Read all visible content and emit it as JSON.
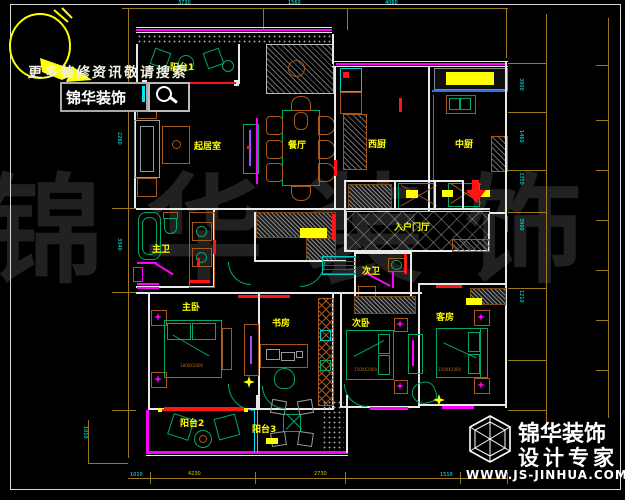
{
  "branding_top": {
    "slogan": "更多装修资讯敬请搜索",
    "brand": "锦华装饰"
  },
  "branding_bottom": {
    "brand": "锦华装饰",
    "tagline": "设计专家",
    "website": "WWW.JS-JINHUA.COM"
  },
  "watermark": {
    "text": "锦华装饰"
  },
  "rooms": [
    {
      "id": "balcony-1",
      "label": "阳台1"
    },
    {
      "id": "living-room",
      "label": "起居室"
    },
    {
      "id": "dining-room",
      "label": "餐厅"
    },
    {
      "id": "west-kitchen",
      "label": "西厨"
    },
    {
      "id": "chinese-kitchen",
      "label": "中厨"
    },
    {
      "id": "entry-hall",
      "label": "入户门厅"
    },
    {
      "id": "master-bath",
      "label": "主卫"
    },
    {
      "id": "second-bath",
      "label": "次卫"
    },
    {
      "id": "master-bedroom",
      "label": "主卧"
    },
    {
      "id": "study",
      "label": "书房"
    },
    {
      "id": "second-bedroom",
      "label": "次卧"
    },
    {
      "id": "guest-room",
      "label": "客房"
    },
    {
      "id": "balcony-2",
      "label": "阳台2"
    },
    {
      "id": "balcony-3",
      "label": "阳台3"
    }
  ],
  "annotations": {
    "master_bed": "1800X2000",
    "second_bed": "1500X2000",
    "guest_bed": "1500X2000"
  },
  "dimensions": {
    "top": [
      "3730",
      "1560",
      "4060"
    ],
    "bottom": [
      "1010",
      "4230",
      "2730",
      "1510"
    ],
    "left": [
      "2260",
      "3340",
      "1010"
    ],
    "right": [
      "3900",
      "1460",
      "3350",
      "3900",
      "1210"
    ]
  },
  "colors": {
    "background": "#000000",
    "wall": "#e8e8e8",
    "window": "#ff00ff",
    "accent_red": "#ff1515",
    "furniture_green": "#00a868",
    "furniture_wood": "#a8571a",
    "label_yellow": "#ffff00",
    "dimension_line": "#9c7a1c",
    "dimension_text": "#00ffff",
    "watermark": "#212121"
  }
}
